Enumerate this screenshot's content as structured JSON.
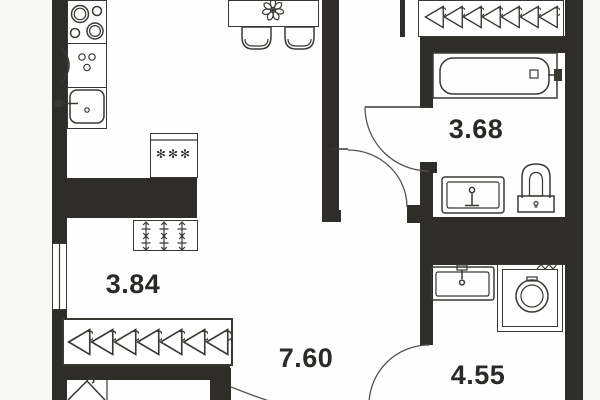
{
  "plan": {
    "rooms": [
      {
        "id": "nook",
        "area_label": "3.84"
      },
      {
        "id": "bathroom",
        "area_label": "3.68"
      },
      {
        "id": "hallway",
        "area_label": "7.60"
      },
      {
        "id": "wc",
        "area_label": "4.55"
      }
    ],
    "symbols": {
      "fridge_stars": "✻✻✻"
    },
    "colors": {
      "wall": "#2f2d2a",
      "line": "#3a3833",
      "paper": "#f7f7f5",
      "floor": "#fefefe",
      "label": "#2b2926",
      "door_arc": "#55534f"
    }
  }
}
